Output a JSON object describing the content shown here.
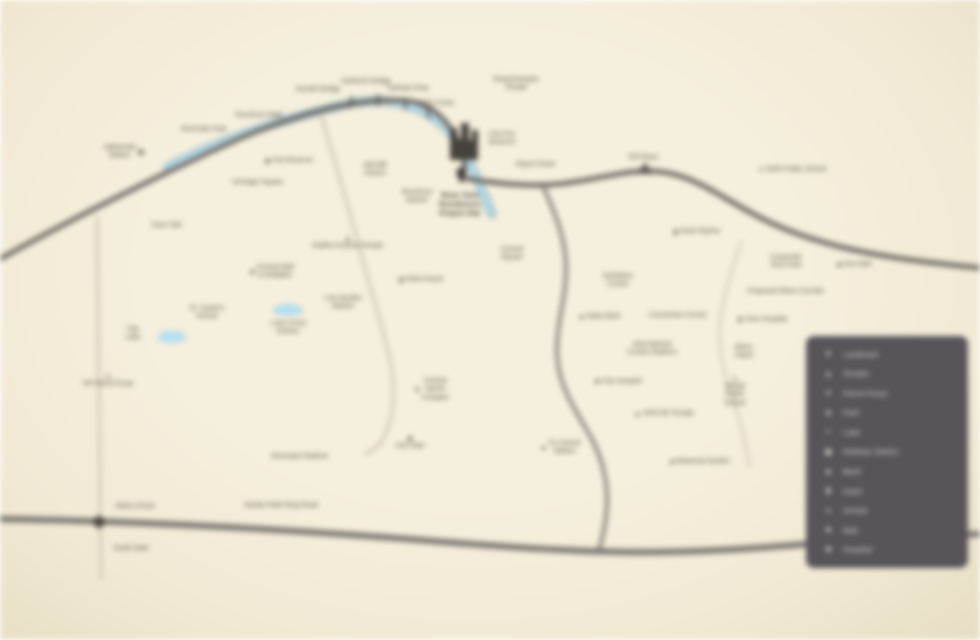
{
  "map": {
    "title": "Project location map",
    "background_color": "#f2ecd9",
    "river_color": "#b6dcea",
    "river_edge_color": "#8aaebc",
    "road_dark_color": "#6e6a64",
    "road_light_color": "#d8d0bb",
    "lake_color": "#b5e3f6",
    "label_color": "#4d463c",
    "labels": [
      {
        "id": "gandhi-bridge",
        "x": 318,
        "y": 90,
        "lines": [
          "Gandhi Bridge"
        ]
      },
      {
        "id": "subhash-bridge",
        "x": 366,
        "y": 82,
        "lines": [
          "Subhash Bridge"
        ]
      },
      {
        "id": "dafnala-ghat",
        "x": 408,
        "y": 89,
        "lines": [
          "Dafnala Ghat"
        ]
      },
      {
        "id": "rto-circle",
        "x": 437,
        "y": 104,
        "lines": [
          "RTO Circle"
        ]
      },
      {
        "id": "swaminarayan-temple",
        "x": 516,
        "y": 84,
        "lines": [
          "Swaminarayan",
          "Temple"
        ]
      },
      {
        "id": "riverfront-walk",
        "x": 259,
        "y": 116,
        "lines": [
          "Riverfront Walk"
        ]
      },
      {
        "id": "riverside-park",
        "x": 204,
        "y": 130,
        "lines": [
          "Riverside Park"
        ]
      },
      {
        "id": "sabarmati-station",
        "x": 124,
        "y": 152,
        "lines": [
          "Sabarmati",
          "Station"
        ],
        "icon": "railway",
        "iconPos": "right"
      },
      {
        "id": "city-museum",
        "x": 289,
        "y": 161,
        "lines": [
          "City Museum"
        ],
        "icon": "landmark",
        "iconPos": "left"
      },
      {
        "id": "heritage-square",
        "x": 258,
        "y": 183,
        "lines": [
          "Heritage Square"
        ]
      },
      {
        "id": "old-mill-district",
        "x": 375,
        "y": 170,
        "lines": [
          "Old Mill",
          "District"
        ]
      },
      {
        "id": "city-fort",
        "x": 502,
        "y": 139,
        "lines": [
          "City Fort",
          "Museum"
        ]
      },
      {
        "id": "airport-road",
        "x": 535,
        "y": 165,
        "lines": [
          "Airport Road"
        ]
      },
      {
        "id": "project-site",
        "x": 460,
        "y": 205,
        "lines": [
          "River View",
          "Residences",
          "Project Site"
        ],
        "emphasis": true
      },
      {
        "id": "riverfront-market",
        "x": 417,
        "y": 197,
        "lines": [
          "Riverfront",
          "Market"
        ]
      },
      {
        "id": "central-square",
        "x": 512,
        "y": 254,
        "lines": [
          "Central",
          "Square"
        ]
      },
      {
        "id": "town-hall",
        "x": 166,
        "y": 226,
        "lines": [
          "Town Hall"
        ]
      },
      {
        "id": "radha-krishna-temple",
        "x": 348,
        "y": 243,
        "lines": [
          "Radha Krishna Temple"
        ],
        "icon": "temple",
        "iconPos": "above"
      },
      {
        "id": "central-mall",
        "x": 272,
        "y": 272,
        "lines": [
          "Central Mall",
          "& Multiplex"
        ],
        "icon": "mall",
        "iconPos": "left"
      },
      {
        "id": "hotel-grand",
        "x": 421,
        "y": 280,
        "lines": [
          "Hotel Grand"
        ],
        "icon": "hotel",
        "iconPos": "left"
      },
      {
        "id": "st-xaviers-school",
        "x": 207,
        "y": 313,
        "lines": [
          "St. Xavier's",
          "School"
        ]
      },
      {
        "id": "law-garden-market",
        "x": 343,
        "y": 303,
        "lines": [
          "Law Garden",
          "Market"
        ]
      },
      {
        "id": "city-lake",
        "x": 133,
        "y": 334,
        "lines": [
          "City",
          "Lake"
        ]
      },
      {
        "id": "lotus-pond-garden",
        "x": 288,
        "y": 328,
        "lines": [
          "Lotus Pond",
          "Garden"
        ]
      },
      {
        "id": "petrol-pump",
        "x": 108,
        "y": 381,
        "lines": [
          "HP Petrol Pump"
        ],
        "icon": "petrol",
        "iconPos": "above"
      },
      {
        "id": "sports-complex",
        "x": 432,
        "y": 390,
        "lines": [
          "Central",
          "Sports",
          "Complex"
        ],
        "icon": "park",
        "iconPos": "left"
      },
      {
        "id": "city-gate",
        "x": 410,
        "y": 443,
        "lines": [
          "City Gate"
        ],
        "icon": "landmark",
        "iconPos": "above"
      },
      {
        "id": "municipal-stadium",
        "x": 300,
        "y": 457,
        "lines": [
          "Municipal Stadium"
        ]
      },
      {
        "id": "ring-road",
        "x": 281,
        "y": 506,
        "lines": [
          "Sardar Patel Ring Road"
        ]
      },
      {
        "id": "nehru-circle",
        "x": 135,
        "y": 507,
        "lines": [
          "Nehru Circle"
        ]
      },
      {
        "id": "south-gate",
        "x": 131,
        "y": 549,
        "lines": [
          "South Gate"
        ]
      },
      {
        "id": "to-central-station",
        "x": 560,
        "y": 448,
        "lines": [
          "To Central",
          "Station"
        ],
        "icon": "arrow-left",
        "iconPos": "left"
      },
      {
        "id": "toll-plaza",
        "x": 643,
        "y": 158,
        "lines": [
          "Toll Plaza"
        ]
      },
      {
        "id": "hotel-skyline",
        "x": 697,
        "y": 232,
        "lines": [
          "Hotel Skyline"
        ],
        "icon": "hotel",
        "iconPos": "left"
      },
      {
        "id": "public-school",
        "x": 792,
        "y": 170,
        "lines": [
          "Delhi Public School"
        ],
        "icon": "school",
        "iconPos": "left"
      },
      {
        "id": "tech-park",
        "x": 786,
        "y": 262,
        "lines": [
          "Corporate",
          "Tech Park"
        ]
      },
      {
        "id": "one-mall",
        "x": 854,
        "y": 265,
        "lines": [
          "One Mall"
        ],
        "icon": "mall",
        "iconPos": "left"
      },
      {
        "id": "metro-corridor",
        "x": 786,
        "y": 292,
        "lines": [
          "Proposed Metro Corridor"
        ]
      },
      {
        "id": "care-hospital",
        "x": 762,
        "y": 320,
        "lines": [
          "Care Hospital"
        ],
        "icon": "hospital",
        "iconPos": "left"
      },
      {
        "id": "exhibition-centre",
        "x": 618,
        "y": 281,
        "lines": [
          "Exhibition",
          "Centre"
        ]
      },
      {
        "id": "state-bank",
        "x": 600,
        "y": 317,
        "lines": [
          "State Bank"
        ],
        "icon": "bank",
        "iconPos": "left"
      },
      {
        "id": "convention-centre",
        "x": 678,
        "y": 316,
        "lines": [
          "Convention Centre"
        ]
      },
      {
        "id": "cricket-stadium",
        "x": 652,
        "y": 349,
        "lines": [
          "International",
          "Cricket Stadium"
        ]
      },
      {
        "id": "metro-depot",
        "x": 744,
        "y": 352,
        "lines": [
          "Metro",
          "Depot"
        ]
      },
      {
        "id": "global-school",
        "x": 735,
        "y": 392,
        "lines": [
          "Global",
          "Public",
          "School"
        ],
        "icon": "school",
        "iconPos": "above"
      },
      {
        "id": "city-hospital",
        "x": 618,
        "y": 382,
        "lines": [
          "City Hospital"
        ],
        "icon": "hospital",
        "iconPos": "left"
      },
      {
        "id": "iskcon-temple",
        "x": 664,
        "y": 414,
        "lines": [
          "ISKCON Temple"
        ],
        "icon": "temple",
        "iconPos": "left"
      },
      {
        "id": "botanical-garden",
        "x": 700,
        "y": 462,
        "lines": [
          "Botanical Garden"
        ],
        "icon": "park",
        "iconPos": "left"
      }
    ]
  },
  "icons": {
    "star": "★",
    "temple": "▲",
    "petrol": "●",
    "park": "♣",
    "lake": "≈",
    "railway": "▣",
    "bank": "◈",
    "hotel": "▮",
    "school": "✦",
    "mall": "■",
    "hospital": "✚",
    "landmark": "◆",
    "arrow-left": "◄"
  },
  "legend": {
    "background_color": "#57545a",
    "text_color": "#efece5",
    "items": [
      {
        "icon": "star",
        "label": "Landmark"
      },
      {
        "icon": "temple",
        "label": "Temple"
      },
      {
        "icon": "petrol",
        "label": "Petrol Pump"
      },
      {
        "icon": "park",
        "label": "Park"
      },
      {
        "icon": "lake",
        "label": "Lake"
      },
      {
        "icon": "railway",
        "label": "Railway Station"
      },
      {
        "icon": "bank",
        "label": "Bank"
      },
      {
        "icon": "hotel",
        "label": "Hotel"
      },
      {
        "icon": "school",
        "label": "School"
      },
      {
        "icon": "mall",
        "label": "Mall"
      },
      {
        "icon": "hospital",
        "label": "Hospital"
      }
    ]
  }
}
